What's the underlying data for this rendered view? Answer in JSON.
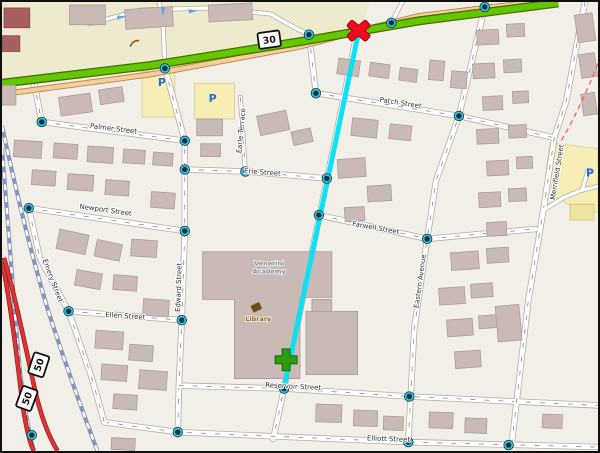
{
  "map": {
    "type": "street-map",
    "background_color": "#f2efe9",
    "landuse_color": "#eeeacd",
    "retail_color": "#f6eeb4",
    "building_color": "#c9bab6",
    "highway_green_color": "#61c800",
    "highway_red_color": "#e03434",
    "railway_color": "#8894b8",
    "route": {
      "color": "#00e2f6",
      "points": [
        [
          359,
          30
        ],
        [
          284,
          389
        ]
      ]
    },
    "markers": {
      "destination_x": {
        "symbol": "X",
        "x": 359,
        "y": 29,
        "color": "#f20a1e"
      },
      "position_plus": {
        "symbol": "+",
        "x": 286,
        "y": 361,
        "color": "#2f9b12"
      }
    },
    "shields": [
      {
        "text": "30",
        "x": 269,
        "y": 38,
        "rot": -8
      },
      {
        "text": "50",
        "x": 37,
        "y": 366,
        "rot": -72
      },
      {
        "text": "50",
        "x": 25,
        "y": 400,
        "rot": -70
      }
    ],
    "street_labels": [
      {
        "text": "Palmer Street",
        "x": 112,
        "y": 130,
        "rot": 7
      },
      {
        "text": "Patch Street",
        "x": 401,
        "y": 104,
        "rot": 9
      },
      {
        "text": "Erie Street",
        "x": 262,
        "y": 174,
        "rot": 4
      },
      {
        "text": "Earle Terrace",
        "x": 243,
        "y": 130,
        "rot": -85
      },
      {
        "text": "Newport Street",
        "x": 104,
        "y": 212,
        "rot": 8
      },
      {
        "text": "Farwell Street",
        "x": 376,
        "y": 230,
        "rot": 10
      },
      {
        "text": "Eastern Avenue",
        "x": 423,
        "y": 282,
        "rot": -82
      },
      {
        "text": "Merrifield Street",
        "x": 561,
        "y": 172,
        "rot": -81
      },
      {
        "text": "Edward Street",
        "x": 180,
        "y": 288,
        "rot": -88
      },
      {
        "text": "Emery Street",
        "x": 49,
        "y": 282,
        "rot": 69
      },
      {
        "text": "Ellen Street",
        "x": 124,
        "y": 319,
        "rot": 4
      },
      {
        "text": "Reservoir Street",
        "x": 293,
        "y": 390,
        "rot": 3
      },
      {
        "text": "Elliott Street",
        "x": 389,
        "y": 443,
        "rot": 2
      }
    ],
    "poi_labels": [
      {
        "name": "library",
        "lines": [
          "Library"
        ],
        "x": 258,
        "y": 322,
        "color": "#8a6d1d"
      },
      {
        "name": "school",
        "lines": [
          "Venerini",
          "Academy"
        ],
        "x": 269,
        "y": 266,
        "color": "#8a8f9c"
      }
    ],
    "parking_symbols": [
      {
        "x": 161,
        "y": 85
      },
      {
        "x": 212,
        "y": 101
      },
      {
        "x": 592,
        "y": 176
      }
    ],
    "oneway_arrows": [
      {
        "x": 121,
        "y": 15,
        "rot": -8
      },
      {
        "x": 162,
        "y": 10,
        "rot": 92
      },
      {
        "x": 193,
        "y": 9,
        "rot": -4
      }
    ],
    "nodes": [
      [
        164,
        67
      ],
      [
        309,
        33
      ],
      [
        392,
        21
      ],
      [
        486,
        5
      ],
      [
        40,
        121
      ],
      [
        184,
        140
      ],
      [
        27,
        208
      ],
      [
        184,
        231
      ],
      [
        184,
        169
      ],
      [
        245,
        171
      ],
      [
        327,
        178
      ],
      [
        316,
        92
      ],
      [
        460,
        115
      ],
      [
        319,
        215
      ],
      [
        428,
        239
      ],
      [
        67,
        312
      ],
      [
        181,
        321
      ],
      [
        284,
        390
      ],
      [
        410,
        398
      ],
      [
        177,
        434
      ],
      [
        409,
        444
      ],
      [
        510,
        447
      ],
      [
        30,
        437
      ]
    ],
    "node_style": {
      "ring_color": "#35c6e3",
      "core_color": "#0a303f"
    }
  }
}
